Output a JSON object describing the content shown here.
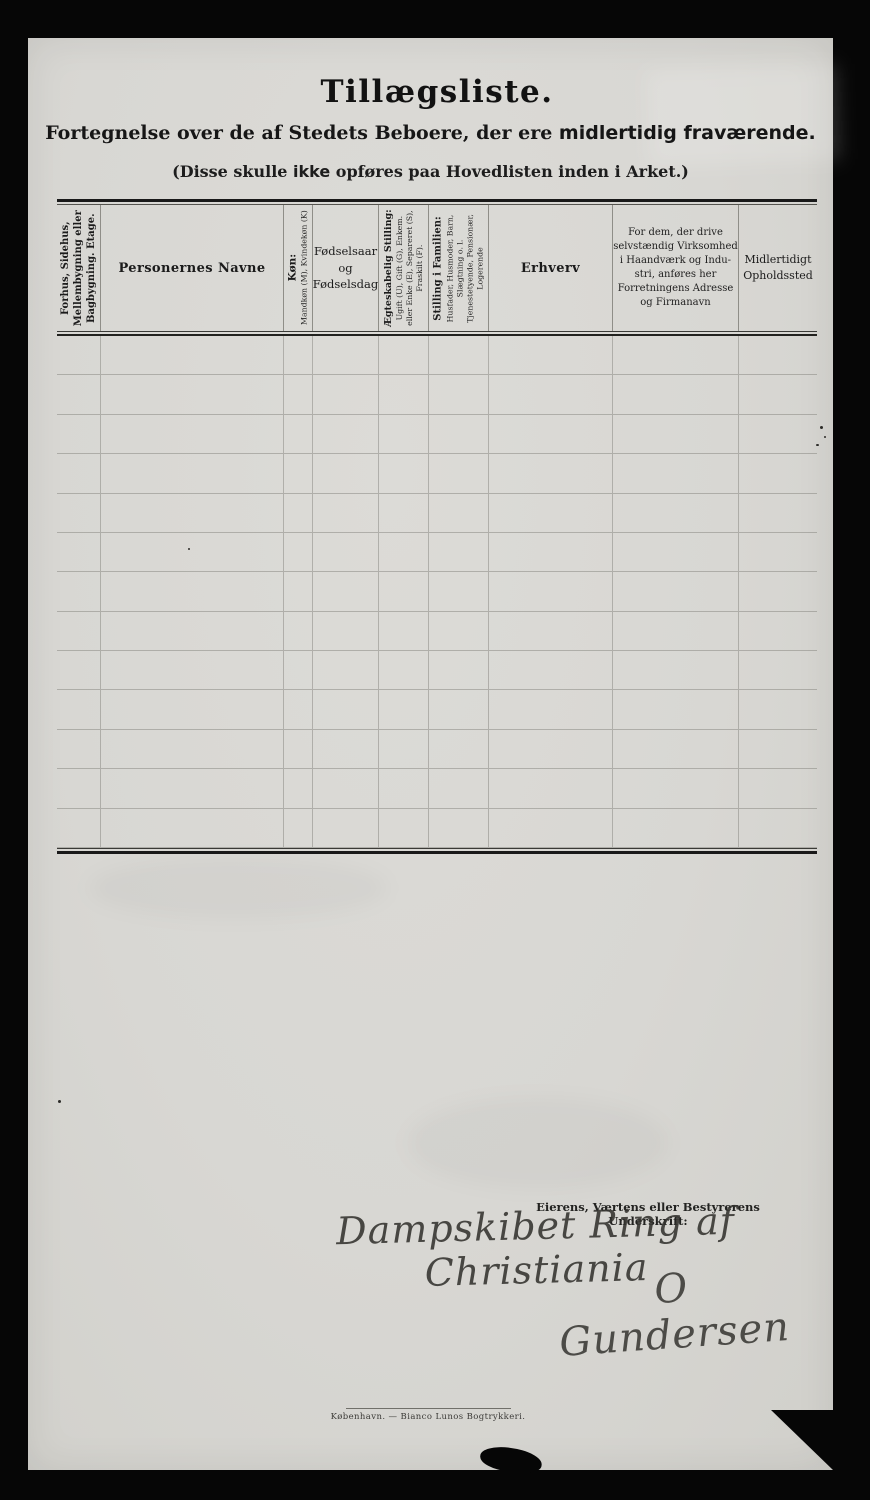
{
  "page": {
    "title": "Tillægsliste.",
    "subtitle_prefix": "Fortegnelse over de af Stedets Beboere, der ere ",
    "subtitle_emphasis": "midlertidig fraværende.",
    "note_prefix": "(Disse skulle ",
    "note_emphasis": "ikke",
    "note_suffix": " opføres paa Hovedlisten inden i Arket.)"
  },
  "table": {
    "row_count": 13,
    "columns": [
      {
        "name": "building",
        "orientation": "vertical",
        "lines": [
          "Forhus, Sidehus,",
          "Mellembygning eller",
          "Bagbygning.  Etage."
        ]
      },
      {
        "name": "names",
        "orientation": "horizontal",
        "title": "Personernes Navne"
      },
      {
        "name": "sex",
        "orientation": "vertical",
        "title": "Køn:",
        "lines": [
          "Mandkøn (M), Kvindekøn (K)"
        ]
      },
      {
        "name": "birth",
        "orientation": "horizontal",
        "lines": [
          "Fødselsaar",
          "og",
          "Fødselsdag"
        ]
      },
      {
        "name": "marital-status",
        "orientation": "vertical",
        "title": "Ægteskabelig Stilling:",
        "lines": [
          "Ugift (U), Gift (G), Enkem.",
          "eller Enke (E), Separeret (S),",
          "Fraskilt (F)."
        ]
      },
      {
        "name": "family-position",
        "orientation": "vertical",
        "title": "Stilling i Familien:",
        "lines": [
          "Husfader, Husmoder, Barn,",
          "Slægtning o. l.",
          "Tjenestetyende, Pensionær,",
          "Logerende"
        ]
      },
      {
        "name": "occupation",
        "orientation": "horizontal",
        "title": "Erhverv"
      },
      {
        "name": "business-address",
        "orientation": "horizontal",
        "lines": [
          "For dem, der drive",
          "selvstændig Virksomhed",
          "i Haandværk og Indu-",
          "stri, anføres her",
          "Forretningens Adresse",
          "og Firmanavn"
        ]
      },
      {
        "name": "temporary-residence",
        "orientation": "horizontal",
        "lines": [
          "Midlertidigt",
          "Opholdssted"
        ]
      }
    ]
  },
  "signature": {
    "label": "Eierens, Værtens eller Bestyrerens Underskrift:",
    "handwritten_line1": "Dampskibet Ring af Christiania",
    "handwritten_line2": "O Gundersen"
  },
  "footer": {
    "imprint": "København. — Bianco Lunos Bogtrykkeri."
  },
  "colors": {
    "background": "#060606",
    "paper": "#d8d7d3",
    "ink": "#1b1b1b",
    "grid_line": "#8f8e88"
  }
}
